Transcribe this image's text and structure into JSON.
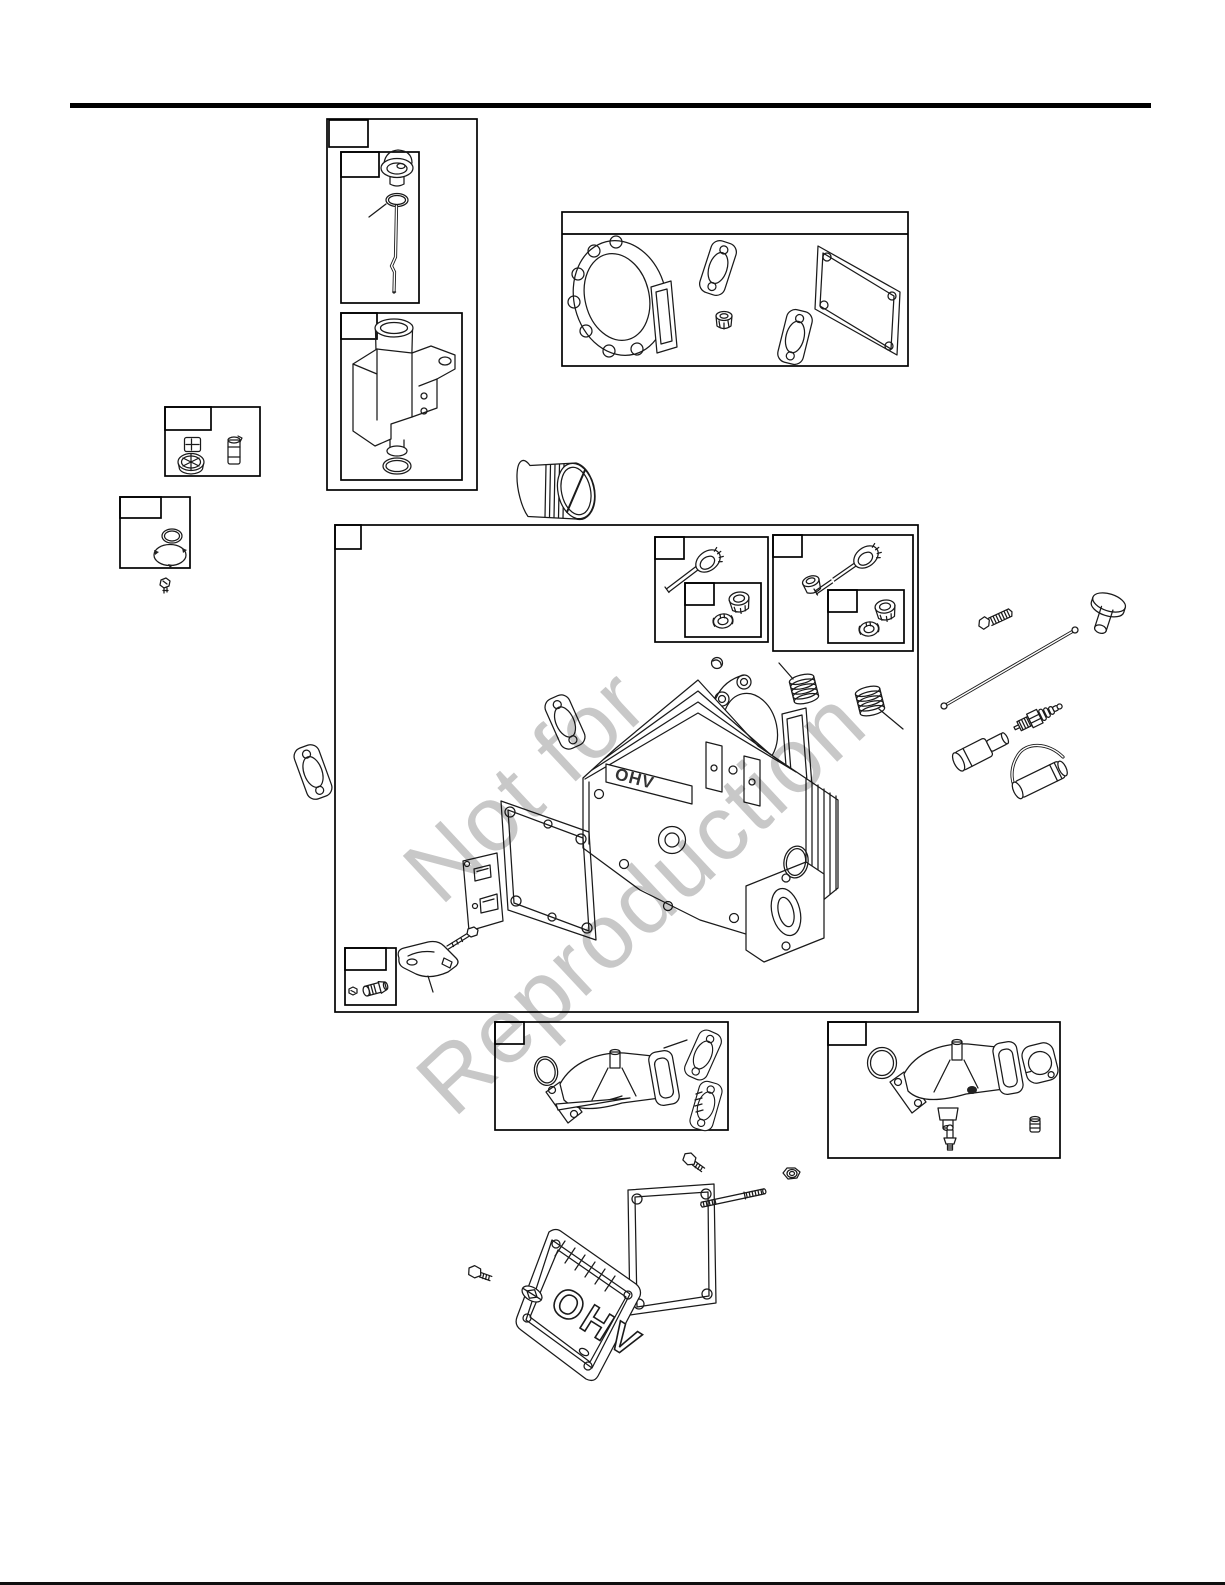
{
  "page": {
    "kind": "illustrated-parts-diagram-scan",
    "background": "#ffffff",
    "rule_color": "#000000",
    "line_color": "#1a1a1a"
  },
  "watermark": {
    "line1": "Not for",
    "line2": "Reproduction",
    "color": "#c8c8c8",
    "rotation_deg": -43,
    "font_size_px": 92
  },
  "cylinder_head": {
    "cast_text": "OHV"
  },
  "valve_cover": {
    "logo_text": "OHV"
  },
  "callouts": {
    "label": "",
    "note": "all part-number callout boxes on this scan are empty"
  },
  "parts": [
    "engine-dipstick",
    "dipstick-o-ring",
    "oil-fill-tube",
    "fill-tube-o-ring",
    "gasket-set",
    "head-gasket",
    "exhaust-port-gasket",
    "valve-stem-seal",
    "intake-port-gasket",
    "valve-cover-gasket",
    "breather-element",
    "oil-fill-cap",
    "filter-cartridge",
    "sump-o-ring",
    "sump-gasket",
    "mounting-screw",
    "oil-filter",
    "cylinder-head",
    "intake-valve",
    "exhaust-valve",
    "valve-keepers",
    "valve-spring-retainer",
    "valve-spring",
    "head-bolt",
    "valve-tappet",
    "push-rod",
    "spark-plug",
    "spark-plug-boot",
    "spark-plug-wrench",
    "rocker-arm",
    "rocker-stud",
    "breather-plate",
    "set-screw-kit",
    "welch-plug",
    "head-o-ring",
    "intake-manifold",
    "exhaust-manifold",
    "manifold-o-ring",
    "manifold-gasket",
    "drain-fitting",
    "pipe-cap",
    "valve-cover",
    "cover-bolt",
    "flange-nut",
    "cover-stud"
  ]
}
